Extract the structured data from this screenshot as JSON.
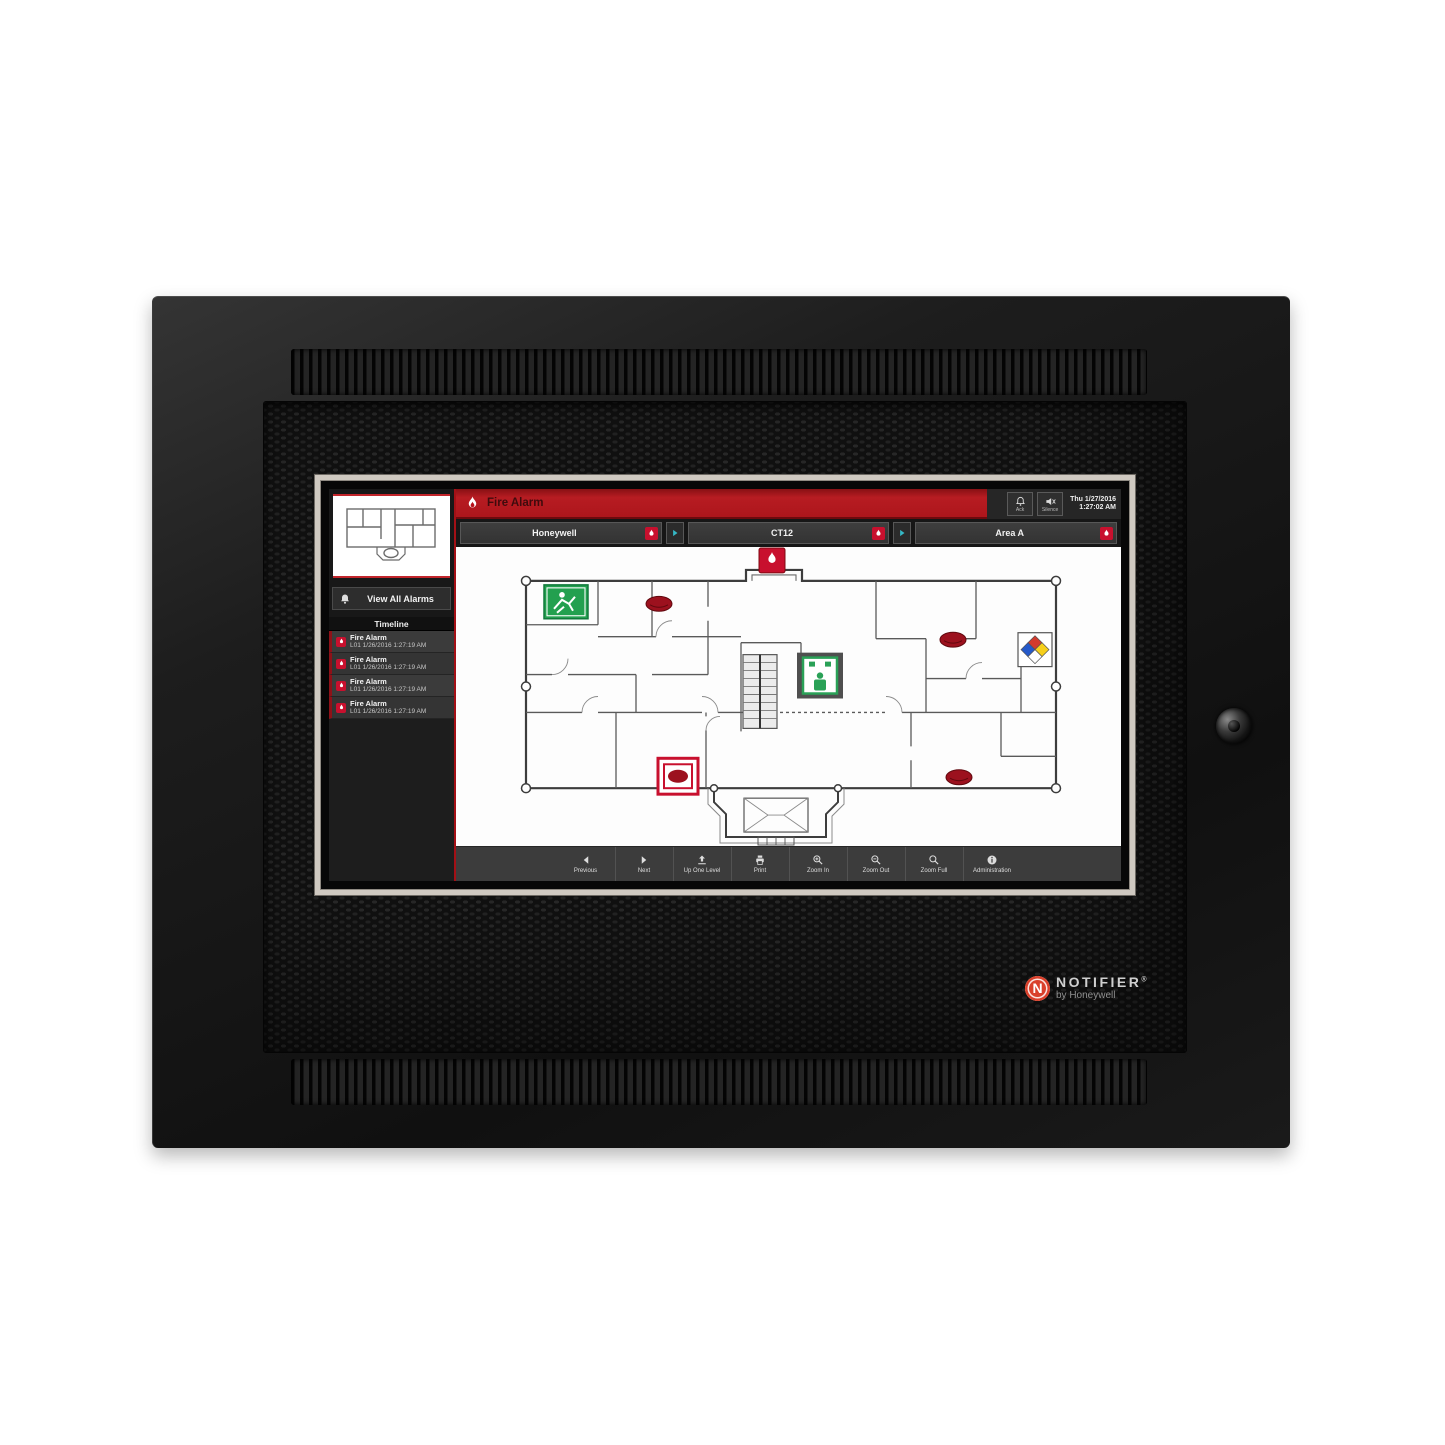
{
  "brand": {
    "logo_letter": "N",
    "name": "NOTIFIER",
    "registered": "®",
    "subtitle": "by Honeywell"
  },
  "screen": {
    "banner": {
      "title": "Fire Alarm",
      "date": "Thu 1/27/2016",
      "time": "1:27:02 AM",
      "ack_label": "Ack",
      "silence_label": "Silence"
    },
    "nav": {
      "segment1": "Honeywell",
      "segment2": "CT12",
      "segment3": "Area A"
    },
    "sidebar": {
      "view_all": "View All Alarms",
      "timeline": "Timeline",
      "entries": [
        {
          "title": "Fire Alarm",
          "time": "L01 1/26/2016 1:27:19 AM"
        },
        {
          "title": "Fire Alarm",
          "time": "L01 1/26/2016 1:27:19 AM"
        },
        {
          "title": "Fire Alarm",
          "time": "L01 1/26/2016 1:27:19 AM"
        },
        {
          "title": "Fire Alarm",
          "time": "L01 1/26/2016 1:27:19 AM"
        }
      ]
    },
    "toolbar": {
      "buttons": [
        {
          "label": "Previous"
        },
        {
          "label": "Next"
        },
        {
          "label": "Up One Level"
        },
        {
          "label": "Print"
        },
        {
          "label": "Zoom In"
        },
        {
          "label": "Zoom Out"
        },
        {
          "label": "Zoom Full"
        },
        {
          "label": "Administration"
        }
      ]
    }
  },
  "colors": {
    "alarm_red": "#b5121b",
    "badge_red": "#c8102e",
    "accent_teal": "#35b8c6",
    "exit_green": "#23a04f",
    "bezel_silver": "#cfc9c1"
  }
}
